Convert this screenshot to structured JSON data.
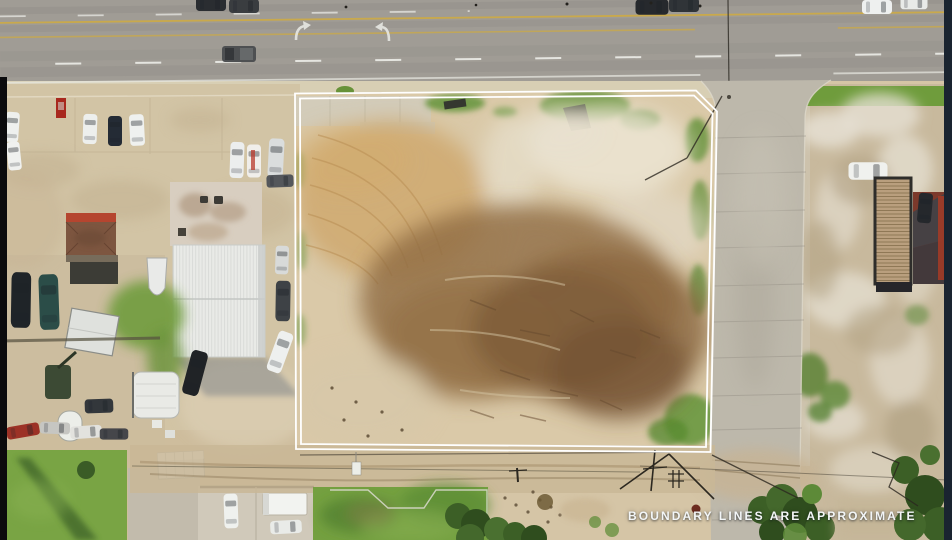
{
  "overlay": {
    "caption": "BOUNDARY LINES ARE APPROXIMATE"
  },
  "boundary": {
    "outer_points": "295,93.5 696,90.5 717,111.5 710.5,452 296,449",
    "inner_points": "300,98.5 694,95.5 712.5,113.5 706,447 301,444"
  },
  "colors": {
    "boundary_line": "#ffffff",
    "caption_text": "#f3f6f7",
    "highway_asphalt": "#a09c95",
    "street_concrete": "#bdb8ab",
    "concrete_apron": "#d2c4a5",
    "lot_dirt_light": "#dac9a8",
    "lot_dirt_brown": "#8f6c42",
    "right_lot_gravel": "#c8b99d",
    "grass_green": "#74a040",
    "tree_green": "#3c5f26",
    "lane_yellow": "#c9a94c",
    "lane_white": "#edeee9",
    "photo_edge_left": "#0b0b0d",
    "photo_edge_right": "#1a2430"
  }
}
